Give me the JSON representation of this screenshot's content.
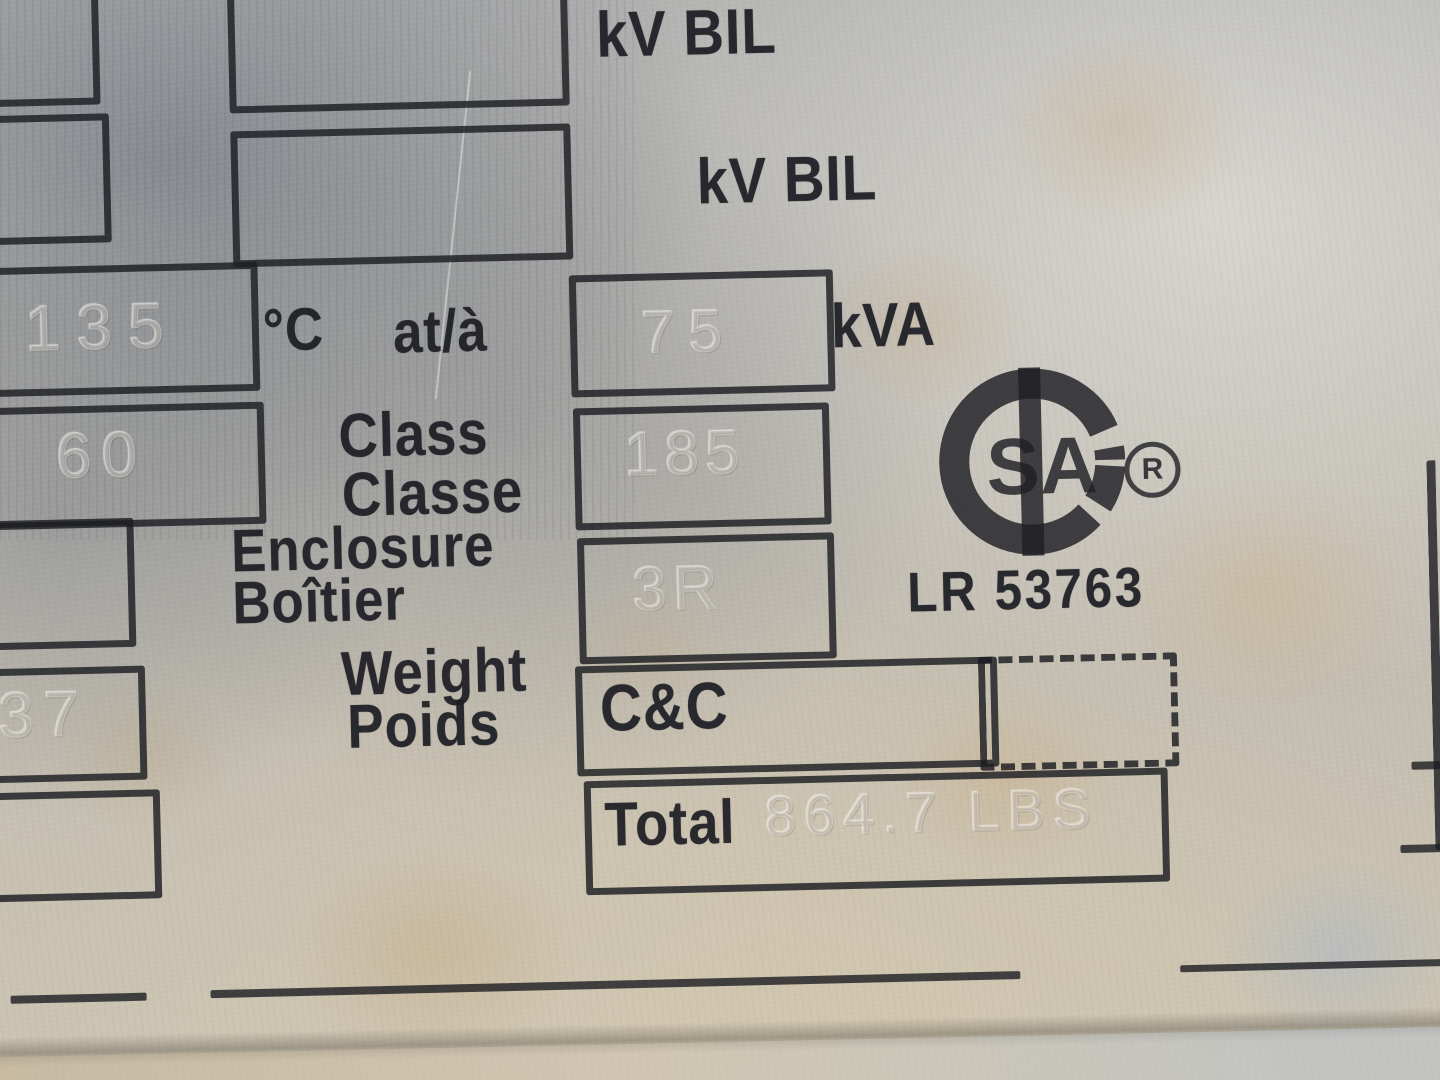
{
  "nameplate": {
    "bil_row_1_label": "kV BIL",
    "bil_row_2_label": "kV BIL",
    "temp_unit_label": "°C",
    "temp_at_label": "at/à",
    "temp_rise_stamp": "135",
    "kva_stamp": "75",
    "kva_unit_label": "kVA",
    "freq_stamp": "60",
    "class_label_en": "Class",
    "class_label_fr": "Classe",
    "class_stamp": "185",
    "enclosure_label_en": "Enclosure",
    "enclosure_label_fr": "Boîtier",
    "enclosure_stamp": "3R",
    "weight_label_en": "Weight",
    "weight_label_fr": "Poids",
    "weight_cc_label": "C&C",
    "total_label": "Total",
    "total_weight_stamp": "864.7 LBS",
    "left_column_stamp": "37"
  },
  "certification": {
    "logo_icon": "csa-monogram-icon",
    "logo_letters": "SA",
    "registered_mark": "R",
    "file_number": "LR 53763"
  },
  "colors": {
    "ink": "#1e1f22",
    "plate_grey": "#9aa0aa",
    "plate_beige": "#cfc6b3",
    "stain_tan": "#c8a878",
    "stain_blue": "#aab6c4"
  }
}
